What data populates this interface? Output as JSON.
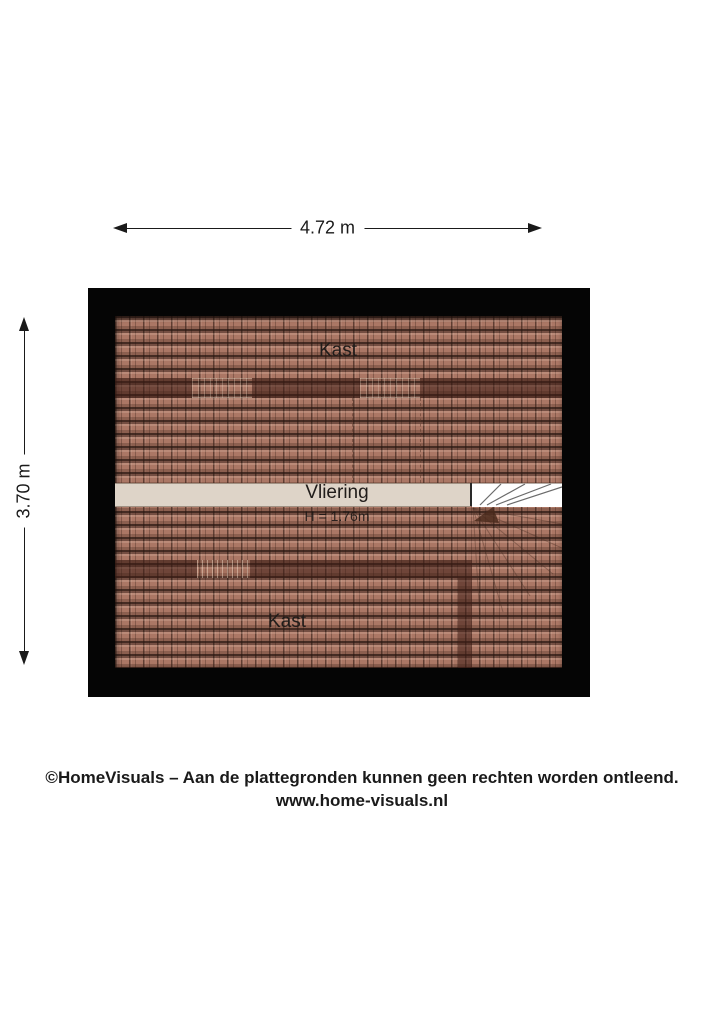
{
  "dimensions": {
    "width_label": "4.72 m",
    "height_label": "3.70 m"
  },
  "floor_plan": {
    "floor_name": "Vliering",
    "rooms": [
      {
        "id": "kast_top",
        "label": "Kast"
      },
      {
        "id": "vliering",
        "label": "Vliering",
        "height_label": "H = 1.76m"
      },
      {
        "id": "kast_bottom",
        "label": "Kast"
      }
    ],
    "labels": {
      "kast_top": "Kast",
      "vliering": "Vliering",
      "vliering_height": "H = 1.76m",
      "kast_bottom": "Kast"
    }
  },
  "footer": {
    "line1": "©HomeVisuals – Aan de plattegronden kunnen geen rechten worden ontleend.",
    "line2": "www.home-visuals.nl"
  },
  "colors": {
    "wall": "#050505",
    "roof_tile": "#ab7765",
    "beam": "#5f3a2b",
    "floor_strip": "#ded4c8",
    "stairs": "#ffffff",
    "text": "#1a1a1a"
  }
}
